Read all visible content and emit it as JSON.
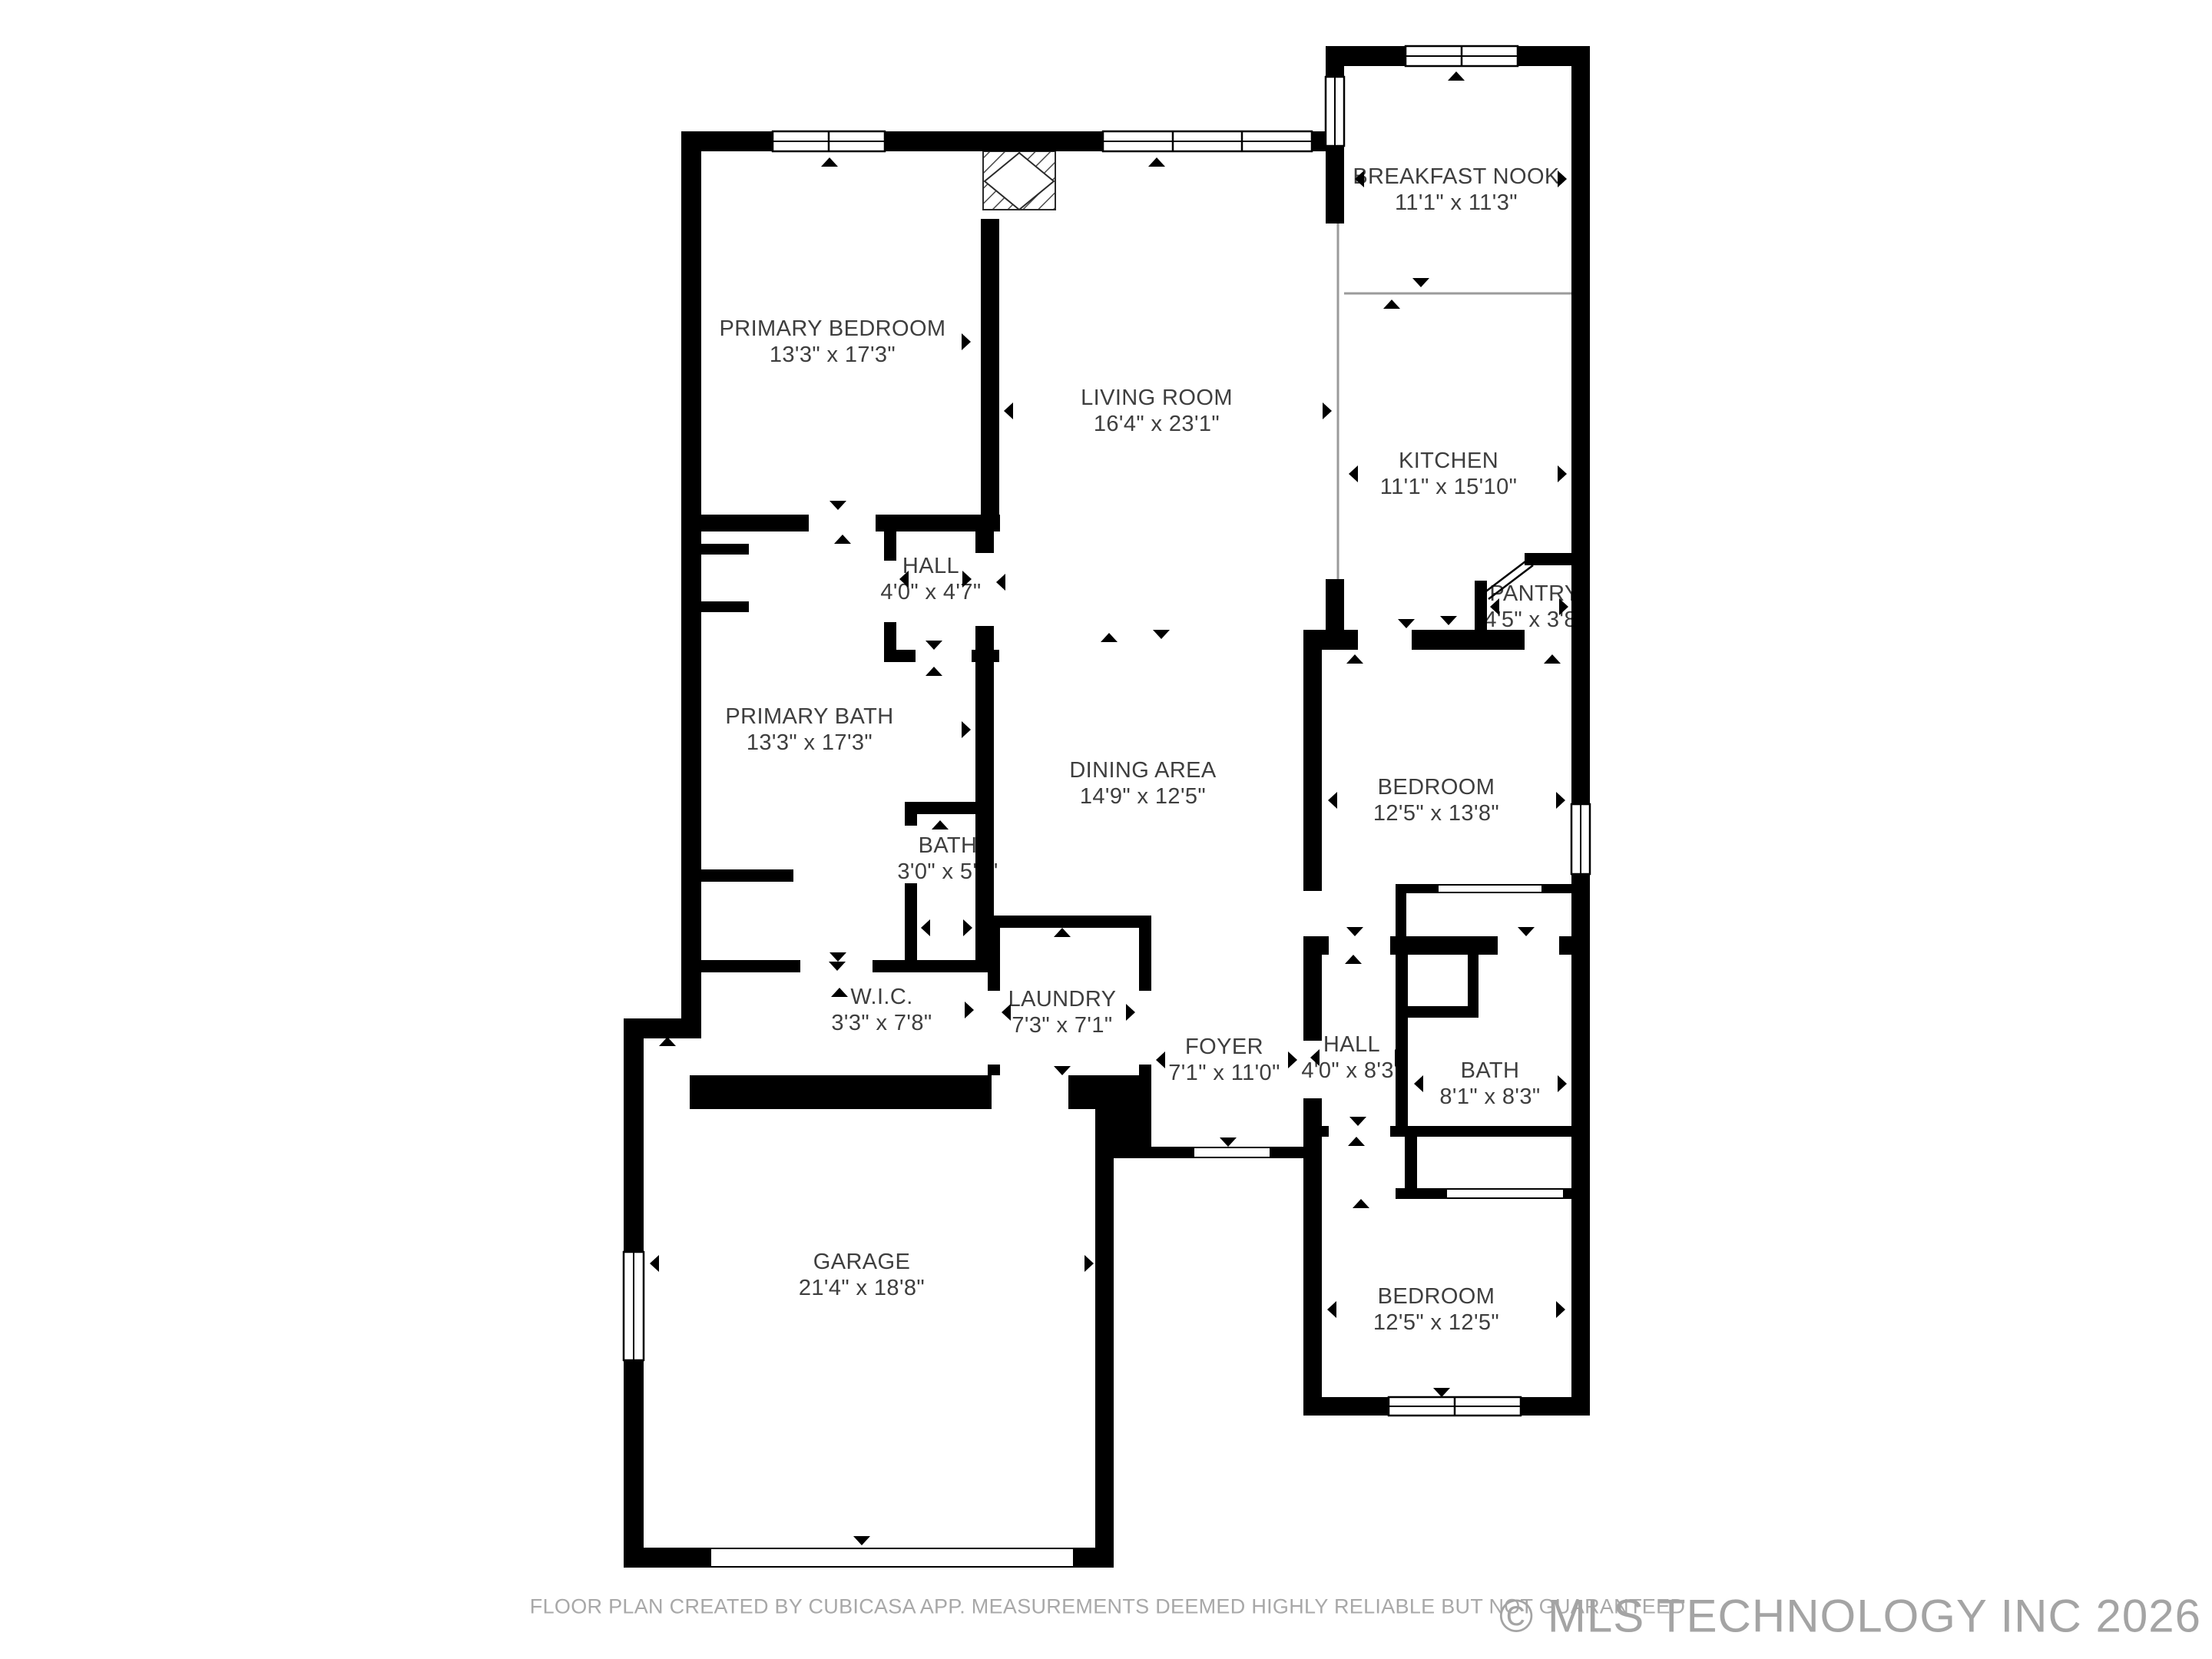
{
  "rooms": [
    {
      "id": "breakfast-nook",
      "name": "BREAKFAST NOOK",
      "dims": "11'1\" x 11'3\""
    },
    {
      "id": "kitchen",
      "name": "KITCHEN",
      "dims": "11'1\" x 15'10\""
    },
    {
      "id": "pantry",
      "name": "PANTRY",
      "dims": "4'5\" x 3'8\""
    },
    {
      "id": "primary-bedroom",
      "name": "PRIMARY BEDROOM",
      "dims": "13'3\" x 17'3\""
    },
    {
      "id": "living-room",
      "name": "LIVING ROOM",
      "dims": "16'4\" x 23'1\""
    },
    {
      "id": "hall-upper",
      "name": "HALL",
      "dims": "4'0\" x 4'7\""
    },
    {
      "id": "primary-bath",
      "name": "PRIMARY BATH",
      "dims": "13'3\" x 17'3\""
    },
    {
      "id": "dining-area",
      "name": "DINING AREA",
      "dims": "14'9\" x 12'5\""
    },
    {
      "id": "bath-small",
      "name": "BATH",
      "dims": "3'0\" x 5'9\""
    },
    {
      "id": "bedroom-east",
      "name": "BEDROOM",
      "dims": "12'5\" x 13'8\""
    },
    {
      "id": "wic",
      "name": "W.I.C.",
      "dims": "3'3\" x 7'8\""
    },
    {
      "id": "laundry",
      "name": "LAUNDRY",
      "dims": "7'3\" x 7'1\""
    },
    {
      "id": "foyer",
      "name": "FOYER",
      "dims": "7'1\" x 11'0\""
    },
    {
      "id": "hall-lower",
      "name": "HALL",
      "dims": "4'0\" x 8'3\""
    },
    {
      "id": "bath-hall",
      "name": "BATH",
      "dims": "8'1\" x 8'3\""
    },
    {
      "id": "bedroom-southeast",
      "name": "BEDROOM",
      "dims": "12'5\" x 12'5\""
    },
    {
      "id": "garage",
      "name": "GARAGE",
      "dims": "21'4\" x 18'8\""
    }
  ],
  "footer": {
    "disclaimer": "FLOOR PLAN CREATED BY CUBICASA APP. MEASUREMENTS DEEMED HIGHLY RELIABLE BUT NOT GUARANTEED",
    "copyright": "© MLS TECHNOLOGY INC 2026"
  },
  "colors": {
    "wall": "#000000",
    "label": "#3e3e3e",
    "divider": "#9b9b9b",
    "footer": "#a8a8a8"
  }
}
